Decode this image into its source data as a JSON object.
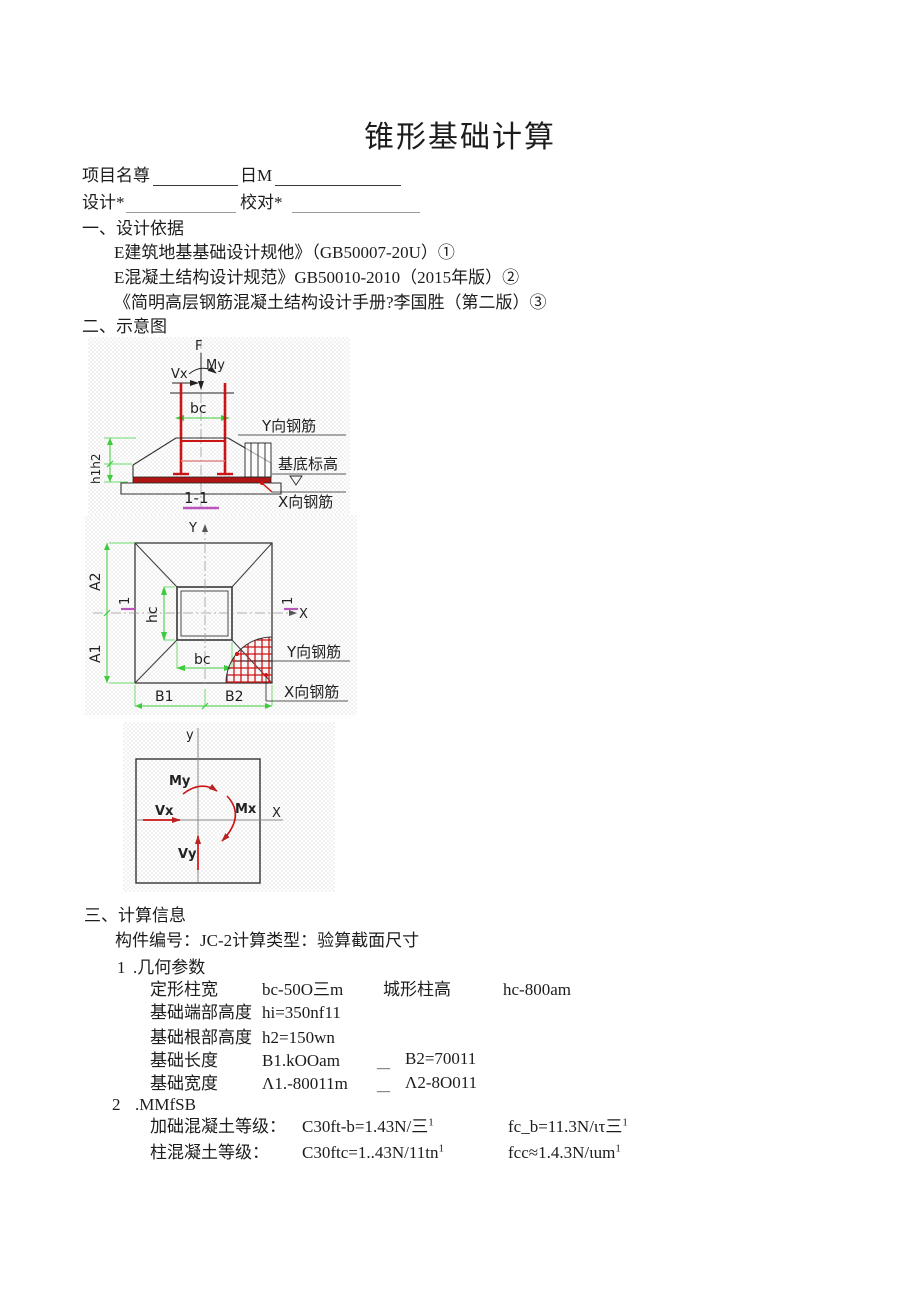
{
  "title": "锥形基础计算",
  "form": {
    "project_label": "项目名尊",
    "date_label": "日M",
    "designer_label": "设计*",
    "checker_label": "校对*"
  },
  "design_basis": {
    "heading": "一、设计依据",
    "refs": [
      "E建筑地基基础设计规他》（GB50007-20U）①",
      "E混凝土结构设计规范》GB50010-2010（2015年版）②",
      "《简明高层钢筋混凝土结构设计手册?李国胜（第二版）③"
    ]
  },
  "schematic": {
    "heading": "二、示意图"
  },
  "calc_info": {
    "heading": "三、计算信息",
    "component_line": "构件编号：JC-2计算类型：验算截面尺寸",
    "geometry": {
      "num": "1",
      "title": ".几何参数",
      "rows": [
        {
          "label": "定形柱宽",
          "value": "bc-50O三m",
          "label2": "城形柱高",
          "value2": "hc-800am"
        },
        {
          "label": "基础端部高度",
          "value": "hi=350nf11"
        },
        {
          "label": "基础根部高度",
          "value": "h2=150wn"
        },
        {
          "label": "基础长度",
          "value": "B1.kOOam",
          "dash": "—",
          "value2": "B2=70011"
        },
        {
          "label": "基础宽度",
          "value": "Λ1.-80011m",
          "dash": "—",
          "value2": "Λ2-8O011"
        }
      ]
    },
    "materials": {
      "num": "2",
      "title": ".MMfSB",
      "rows": [
        {
          "label": "加础混凝土等级：",
          "value": "C30ft-b=1.43N/三",
          "sup": "1",
          "value2": "fc_b=11.3N/ιτ三",
          "sup2": "1"
        },
        {
          "label": "柱混凝土等级：",
          "value": "C30ftc=1..43N/11tn",
          "sup": "1",
          "value2": "fcc≈1.4.3N/ιum",
          "sup2": "1"
        }
      ]
    }
  },
  "diagrams": {
    "section_view": {
      "F": "F",
      "My": "My",
      "Vx": "Vx",
      "bc": "bc",
      "h_dim": "h1h2",
      "y_rebar": "Y向钢筋",
      "base_level": "基底标高",
      "x_rebar": "X向钢筋",
      "section_mark": "1-1"
    },
    "plan_view": {
      "y_axis": "Y",
      "x_axis": "X",
      "A2": "A2",
      "A1": "A1",
      "hc": "hc",
      "bc": "bc",
      "B1": "B1",
      "B2": "B2",
      "sec_left": "1",
      "sec_right": "1",
      "y_rebar": "Y向钢筋",
      "x_rebar": "X向钢筋"
    },
    "load_convention": {
      "y_axis": "y",
      "x_axis": "X",
      "My": "My",
      "Mx": "Mx",
      "Vx": "Vx",
      "Vy": "Vy"
    }
  },
  "colors": {
    "rebar_red": "#cc1414",
    "dim_green": "#3ecc3e",
    "section_magenta": "#bb55bb",
    "axis_gray": "#8a8a8a",
    "ink": "#1c1c1c"
  }
}
